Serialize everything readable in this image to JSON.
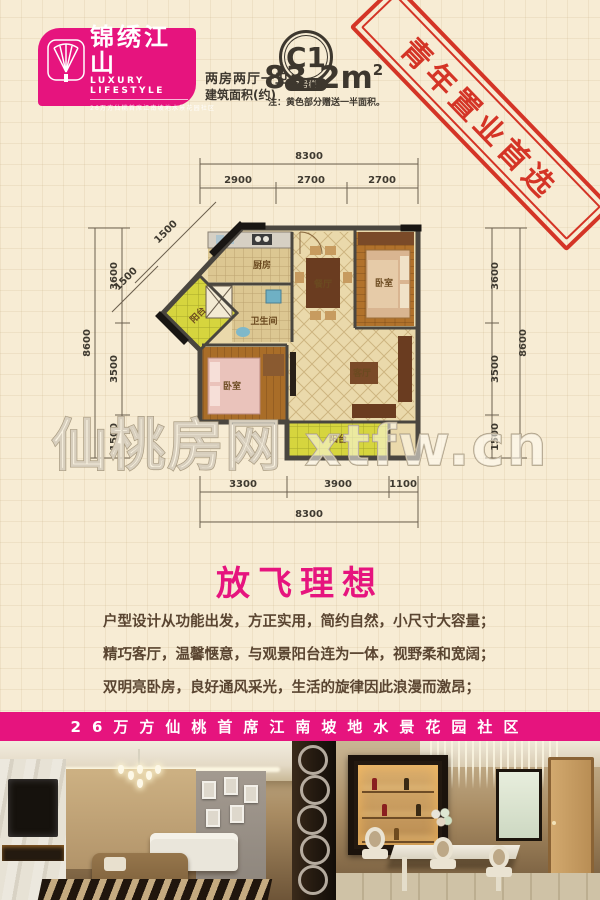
{
  "logo": {
    "name": "锦绣江山",
    "subtitle": "LUXURY LIFESTYLE",
    "tagline": "26万方仙桃首席江南坡地水景花园社区"
  },
  "unit": {
    "badge": "C1",
    "building": "1号楼",
    "rooms_label": "两房两厅一卫",
    "area_label": "建筑面积(约)",
    "area_value": "83.2m",
    "area_sup": "2",
    "note": "注：黄色部分赠送一半面积。"
  },
  "stamp": {
    "text": "青年置业首选"
  },
  "floorplan": {
    "watermark": "仙桃房网 xtfw.cn",
    "rooms": {
      "kitchen": "厨房",
      "bath": "卫生间",
      "dining": "餐厅",
      "bedroom_top": "卧室",
      "bedroom_bottom": "卧室",
      "living": "客厅",
      "balcony_side": "阳台",
      "balcony_bottom": "阳台"
    },
    "dims": {
      "top_total": "8300",
      "top": [
        "2900",
        "2700",
        "2700"
      ],
      "left_total": "8600",
      "left": [
        "3600",
        "3500",
        "1500"
      ],
      "right_total": "8600",
      "right": [
        "3600",
        "3500",
        "1500"
      ],
      "bottom": [
        "3300",
        "3900",
        "1100"
      ],
      "bottom_total": "8300",
      "diag": [
        "1500",
        "1500"
      ]
    }
  },
  "headline": {
    "title": "放飞理想"
  },
  "description": {
    "lines": [
      "户型设计从功能出发，方正实用，简约自然，小尺寸大容量；",
      "精巧客厅，温馨惬意，与观景阳台连为一体，视野柔和宽阔；",
      "双明亮卧房，良好通风采光，生活的旋律因此浪漫而激昂；"
    ]
  },
  "banner": {
    "text": "26万方仙桃首席江南坡地水景花园社区"
  },
  "colors": {
    "brand_magenta": "#e6147e",
    "stamp_red": "#d32b1d",
    "background_cream": "#f7ecd4",
    "balcony_yellow": "#d6d53e",
    "wall_gray": "#4a463f",
    "wood_brown": "#b1722b",
    "text_brown": "#5a4531"
  }
}
